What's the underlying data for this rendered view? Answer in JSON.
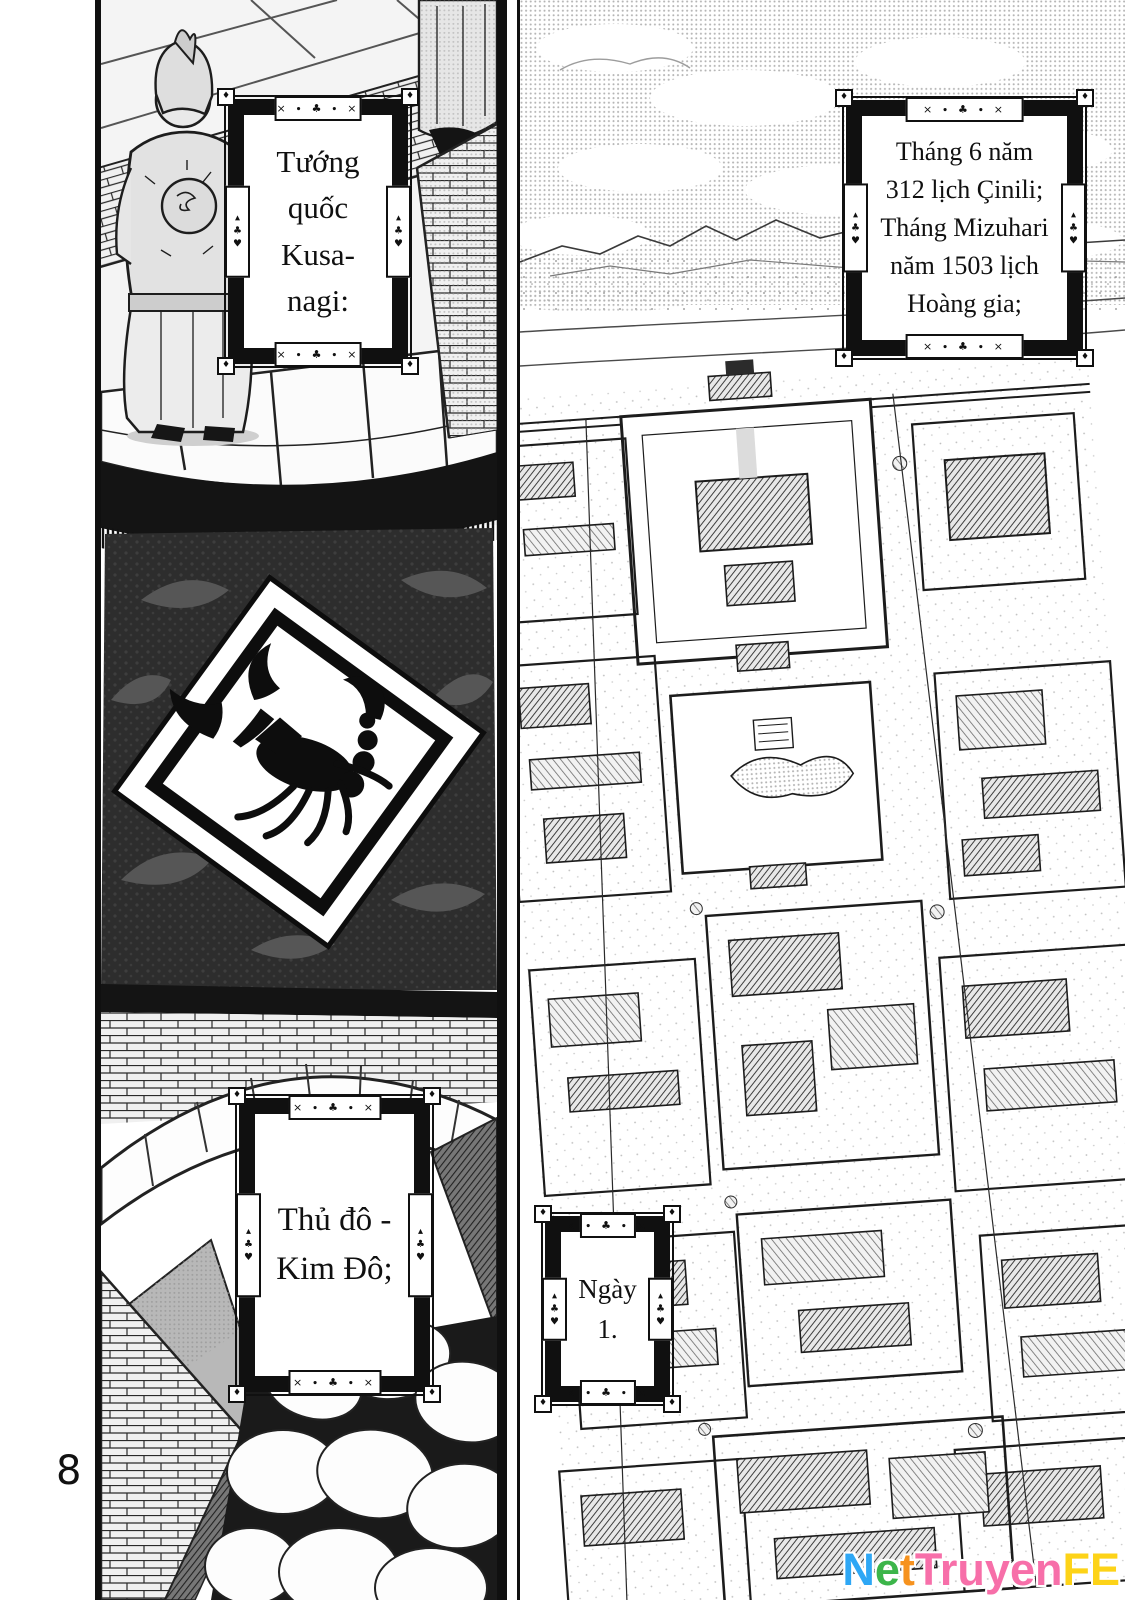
{
  "page": {
    "number": "8",
    "background": "#ffffff",
    "ink": "#101010"
  },
  "panels": {
    "left": {
      "name": "citadel wall with scorpion banner",
      "caption_general": "Tướng\nquốc\nKusa-\nnagi:",
      "caption_capital": "Thủ đô -\nKim Đô;",
      "emblem": "scorpion-banner"
    },
    "right": {
      "name": "aerial view of the capital city",
      "caption_date": "Tháng 6 năm\n312 lịch Çinili;\nTháng Mizuhari\nnăm 1503 lịch\nHoàng gia;",
      "caption_day": "Ngày\n1."
    }
  },
  "frame_ornament": {
    "horizontal": "× ∙ ♣ ∙ ×",
    "vertical": "▴\n♣\n♥",
    "corner": "♦"
  },
  "watermark": {
    "text": "NetTruyenFE",
    "letters": [
      {
        "ch": "N",
        "color": "#2ea7f5"
      },
      {
        "ch": "e",
        "color": "#3cb54a"
      },
      {
        "ch": "t",
        "color": "#f6921e"
      },
      {
        "ch": "T",
        "color": "#f76fa9"
      },
      {
        "ch": "r",
        "color": "#f76fa9"
      },
      {
        "ch": "u",
        "color": "#f76fa9"
      },
      {
        "ch": "y",
        "color": "#f76fa9"
      },
      {
        "ch": "e",
        "color": "#f76fa9"
      },
      {
        "ch": "n",
        "color": "#f76fa9"
      },
      {
        "ch": "F",
        "color": "#fdd318"
      },
      {
        "ch": "E",
        "color": "#fdd318"
      }
    ]
  }
}
